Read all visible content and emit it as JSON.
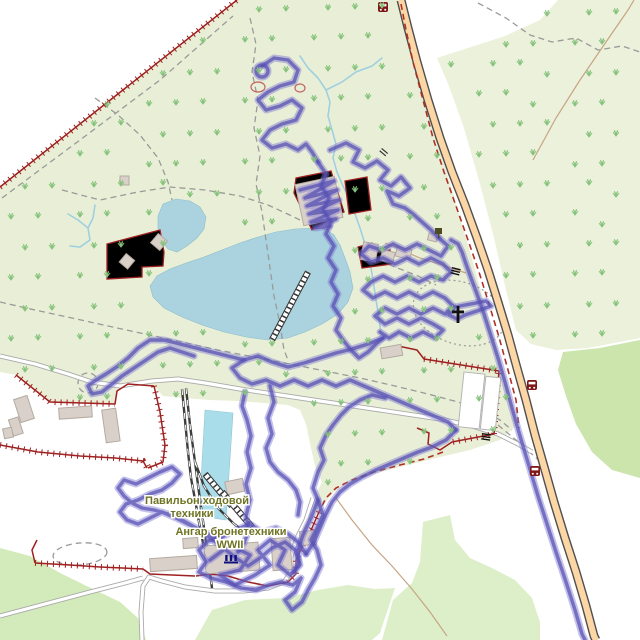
{
  "map": {
    "labels": {
      "pavilion_line1": "Павильон ходовой",
      "pavilion_line2": "техники",
      "hangar_line1": "Ангар бронетехники",
      "hangar_line2": "WWII"
    },
    "colors": {
      "park_green": "#e9efd6",
      "grass_patch": "#cbe5ac",
      "water": "#aad3df",
      "pool": "#a9dde9",
      "road_fill": "#fcd6a4",
      "road_casing": "#4f4f4f",
      "boundary_red": "#b03024",
      "fence_red": "#9e2020",
      "gps_track_purple": "#5650b2",
      "label_olive": "#6f7422",
      "building": "#d9d0c9",
      "path_gray": "#9a9a9a",
      "stream_blue": "#9fd0e0",
      "scrub_green": "#86c27c"
    },
    "icons": [
      {
        "name": "bus-stop-icon",
        "count": 3
      },
      {
        "name": "christian-cross-icon",
        "count": 1
      },
      {
        "name": "museum-icon",
        "count": 1
      },
      {
        "name": "information-board-icon",
        "count": 1
      },
      {
        "name": "gate-icon",
        "count": 2
      },
      {
        "name": "culvert-icon",
        "count": 1
      }
    ]
  }
}
